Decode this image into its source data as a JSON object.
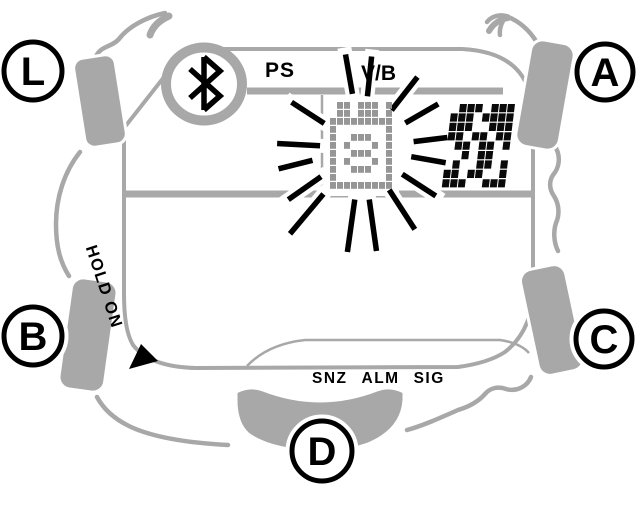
{
  "diagram": {
    "type": "digital-watch-display-diagram"
  },
  "colors": {
    "case_gray": "#a8a8a8",
    "black": "#000000",
    "blink_icon_gray": "#969696",
    "runner_black": "#0a0a0a",
    "white": "#ffffff"
  },
  "callouts": {
    "light": "L",
    "top_right": "A",
    "bottom_left": "B",
    "bottom_right": "C",
    "front": "D"
  },
  "display": {
    "bluetooth_icon": "bluetooth-rune",
    "top_indicators": {
      "power_save": "PS",
      "vibration": "V/B"
    },
    "bottom_indicators": {
      "snooze": "SNZ",
      "alarm": "ALM",
      "signal": "SIG"
    },
    "hold_on_label": "HOLD ON",
    "hold_on_arrow": "triangle-arrow"
  },
  "blink_icon": {
    "name": "blinking-alarm-number-icon",
    "center": [
      362,
      148
    ],
    "origin": [
      330,
      102
    ],
    "cell": [
      7,
      8
    ],
    "matrix": [
      "011011101",
      "011011101",
      "111111111",
      "100000001",
      "100111001",
      "101000101",
      "100111001",
      "101000101",
      "100111001",
      "100000001",
      "111111111"
    ]
  },
  "runner_icon": {
    "name": "runner-pixel-graphic",
    "origin": [
      452,
      104
    ],
    "cell": [
      8,
      9.4
    ],
    "skew_deg": -7,
    "matrix": [
      "01110111",
      "11101111",
      "11100111",
      "11011011",
      "01101101",
      "00101100",
      "01001101",
      "11011001",
      "11100111"
    ]
  },
  "rays": [
    [
      147,
      45,
      84
    ],
    [
      100,
      55,
      95
    ],
    [
      84,
      52,
      92
    ],
    [
      52,
      48,
      90
    ],
    [
      30,
      50,
      88
    ],
    [
      7,
      52,
      86
    ],
    [
      -10,
      50,
      85
    ],
    [
      -33,
      48,
      88
    ],
    [
      -57,
      50,
      97
    ],
    [
      -82,
      52,
      104
    ],
    [
      -98,
      52,
      105
    ],
    [
      -130,
      60,
      112
    ],
    [
      -145,
      50,
      90
    ],
    [
      -166,
      51,
      86
    ],
    [
      177,
      42,
      85
    ]
  ]
}
